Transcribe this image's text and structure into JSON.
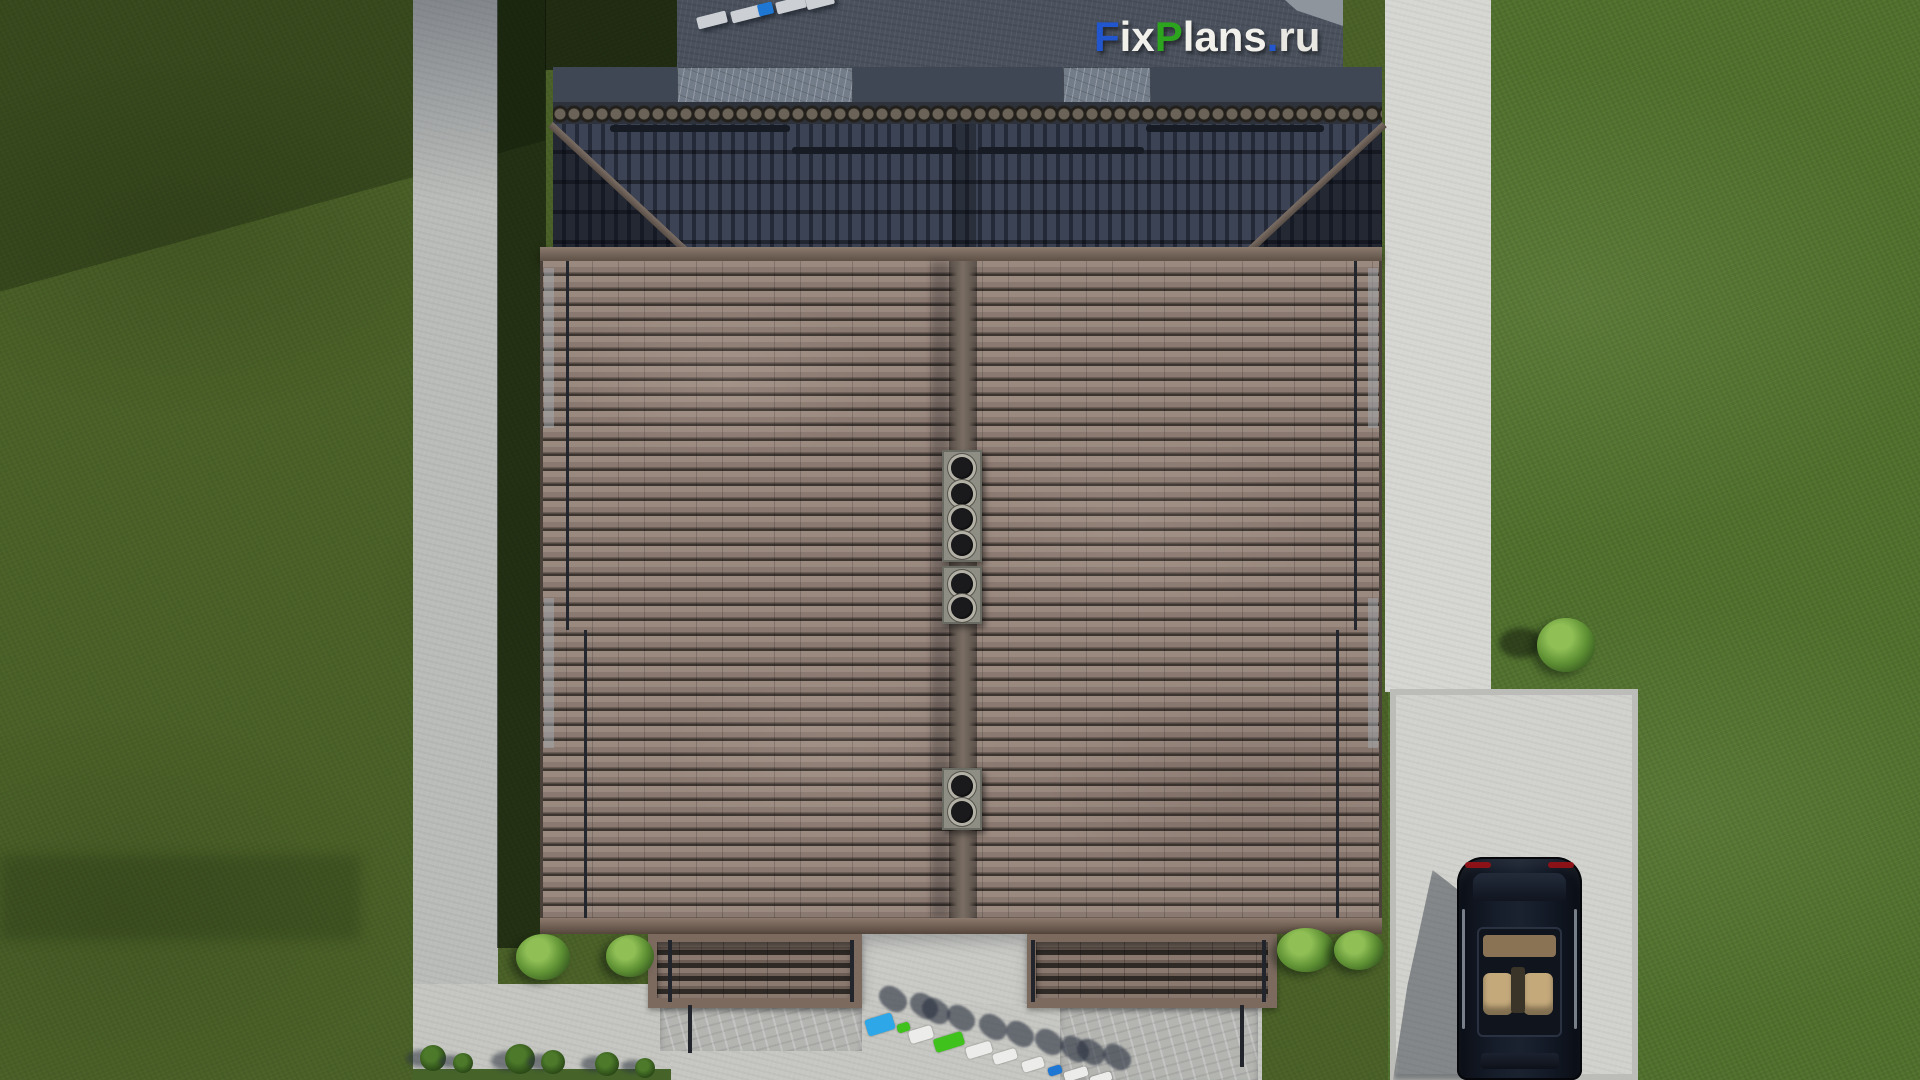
{
  "meta": {
    "description": "Top-down 3D architectural render of a duplex house with hip roof, lawns, concrete paths, parked car and people",
    "watermark": "FixPlans.ru"
  },
  "logo": {
    "text": "FixPlans.ru",
    "letters": [
      {
        "ch": "F",
        "color": "#2156ce"
      },
      {
        "ch": "i",
        "color": "#f1f0ea"
      },
      {
        "ch": "x",
        "color": "#f1f0ea"
      },
      {
        "ch": "P",
        "color": "#2ca41d"
      },
      {
        "ch": "l",
        "color": "#f1f0ea"
      },
      {
        "ch": "a",
        "color": "#f1f0ea"
      },
      {
        "ch": "n",
        "color": "#f1f0ea"
      },
      {
        "ch": "s",
        "color": "#f1f0ea"
      },
      {
        "ch": ".",
        "color": "#2156ce"
      },
      {
        "ch": "r",
        "color": "#e8e7e1"
      },
      {
        "ch": "u",
        "color": "#e8e7e1"
      }
    ]
  },
  "palette": {
    "lawn": "#50702d",
    "lawn_shadow": "rgba(10,16,6,0.6)",
    "concrete_bright": "#d6d7d2",
    "concrete_shaded": "#4b525e",
    "roof_lit": "#8d7c73",
    "roof_dark": "#272d3b",
    "fascia": "#7e6c60",
    "car": "#0d1118",
    "person_blue": "#2da7e8",
    "person_deep_blue": "#1f77d4",
    "person_green": "#3fc21c",
    "person_white": "#ececea",
    "slab_gray": "#ccd0d5"
  },
  "objects": {
    "snow_bars": [
      {
        "x": 610,
        "y": 125,
        "w": 180
      },
      {
        "x": 792,
        "y": 147,
        "w": 166
      },
      {
        "x": 978,
        "y": 147,
        "w": 166
      },
      {
        "x": 1146,
        "y": 125,
        "w": 178
      }
    ],
    "rods": [
      {
        "x": 566,
        "y": 261,
        "h": 369
      },
      {
        "x": 584,
        "y": 630,
        "h": 288
      },
      {
        "x": 1354,
        "y": 261,
        "h": 369
      },
      {
        "x": 1336,
        "y": 630,
        "h": 288
      }
    ],
    "eave_strips": [
      {
        "x": 544,
        "y": 268,
        "h": 160
      },
      {
        "x": 544,
        "y": 598,
        "h": 150
      },
      {
        "x": 1368,
        "y": 268,
        "h": 160
      },
      {
        "x": 1368,
        "y": 598,
        "h": 150
      }
    ],
    "chimneys": [
      {
        "x": 942,
        "y": 450,
        "w": 40,
        "h": 112,
        "flues": 4
      },
      {
        "x": 942,
        "y": 566,
        "w": 40,
        "h": 58,
        "flues": 2
      },
      {
        "x": 942,
        "y": 768,
        "w": 40,
        "h": 62,
        "flues": 2
      }
    ],
    "downpipes": [
      {
        "x": 668,
        "y": 940,
        "h": 62
      },
      {
        "x": 850,
        "y": 940,
        "h": 62
      },
      {
        "x": 1031,
        "y": 940,
        "h": 62
      },
      {
        "x": 1262,
        "y": 940,
        "h": 62
      },
      {
        "x": 688,
        "y": 1005,
        "h": 48
      },
      {
        "x": 1240,
        "y": 1005,
        "h": 62
      }
    ],
    "bushes": [
      {
        "x": 516,
        "y": 934,
        "w": 54,
        "h": 46
      },
      {
        "x": 606,
        "y": 935,
        "w": 48,
        "h": 42
      },
      {
        "x": 1277,
        "y": 928,
        "w": 58,
        "h": 44
      },
      {
        "x": 1334,
        "y": 930,
        "w": 50,
        "h": 40
      },
      {
        "x": 1537,
        "y": 618,
        "w": 58,
        "h": 54,
        "shadow": {
          "dx": -38,
          "dy": 10,
          "w": 44,
          "h": 30
        }
      }
    ],
    "trees": [
      {
        "x": 433,
        "y": 1058,
        "r": 13
      },
      {
        "x": 463,
        "y": 1063,
        "r": 10
      },
      {
        "x": 520,
        "y": 1059,
        "r": 15
      },
      {
        "x": 553,
        "y": 1062,
        "r": 12
      },
      {
        "x": 607,
        "y": 1064,
        "r": 12
      },
      {
        "x": 645,
        "y": 1068,
        "r": 10
      }
    ],
    "people_bottom": [
      {
        "x": 866,
        "y": 1016,
        "w": 28,
        "h": 17,
        "color": "person_blue"
      },
      {
        "x": 897,
        "y": 1023,
        "w": 13,
        "h": 9,
        "color": "person_green"
      },
      {
        "x": 909,
        "y": 1028,
        "w": 24,
        "h": 13,
        "color": "person_white"
      },
      {
        "x": 934,
        "y": 1035,
        "w": 30,
        "h": 14,
        "color": "person_green"
      },
      {
        "x": 966,
        "y": 1044,
        "w": 26,
        "h": 12,
        "color": "person_white"
      },
      {
        "x": 993,
        "y": 1051,
        "w": 24,
        "h": 11,
        "color": "person_white"
      },
      {
        "x": 1022,
        "y": 1059,
        "w": 22,
        "h": 11,
        "color": "person_white"
      },
      {
        "x": 1048,
        "y": 1066,
        "w": 14,
        "h": 9,
        "color": "person_deep_blue"
      },
      {
        "x": 1064,
        "y": 1069,
        "w": 24,
        "h": 10,
        "color": "person_white"
      },
      {
        "x": 1090,
        "y": 1074,
        "w": 22,
        "h": 9,
        "color": "person_white"
      }
    ],
    "people_top": [
      {
        "x": 697,
        "y": 14,
        "w": 30,
        "h": 12,
        "color": "slab_gray"
      },
      {
        "x": 731,
        "y": 8,
        "w": 30,
        "h": 12,
        "color": "slab_gray"
      },
      {
        "x": 758,
        "y": 3,
        "w": 15,
        "h": 12,
        "color": "person_deep_blue"
      },
      {
        "x": 776,
        "y": -1,
        "w": 30,
        "h": 12,
        "color": "slab_gray"
      },
      {
        "x": 806,
        "y": -5,
        "w": 28,
        "h": 12,
        "color": "slab_gray"
      }
    ]
  }
}
